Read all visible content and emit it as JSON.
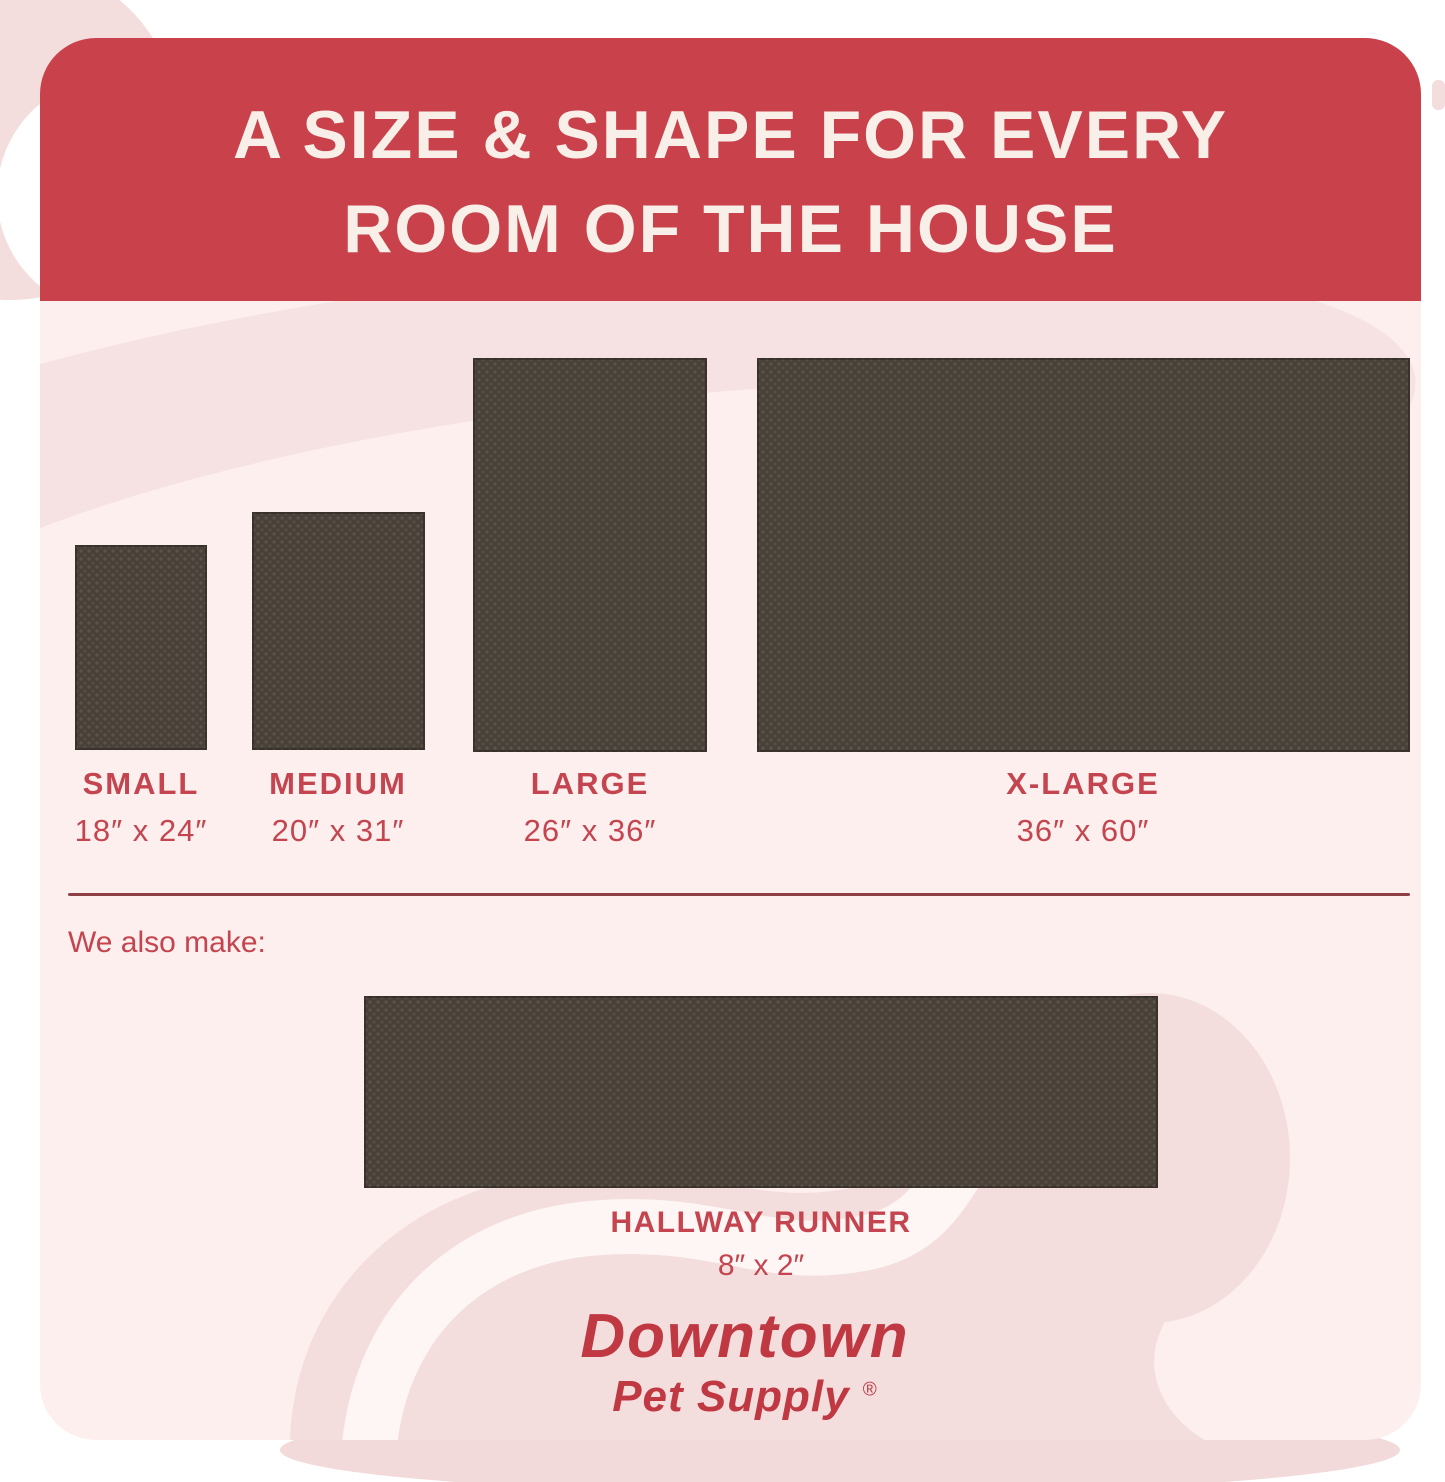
{
  "header": {
    "title_line1": "A SIZE & SHAPE FOR EVERY",
    "title_line2": "ROOM OF THE HOUSE"
  },
  "sizes": [
    {
      "name": "SMALL",
      "dims": "18″ x 24″"
    },
    {
      "name": "MEDIUM",
      "dims": "20″ x 31″"
    },
    {
      "name": "LARGE",
      "dims": "26″ x 36″"
    },
    {
      "name": "X-LARGE",
      "dims": "36″ x 60″"
    }
  ],
  "also_make": {
    "label": "We also make:"
  },
  "runner": {
    "name": "HALLWAY RUNNER",
    "dims": "8″ x 2″"
  },
  "brand": {
    "name": "Downtown",
    "tagline": "Pet Supply",
    "registered": "®"
  },
  "colors": {
    "banner_red": "#c8414b",
    "banner_text": "#f8efe8",
    "label_red": "#c4454f",
    "logo_red": "#bf3842",
    "rug_brown": "#48413a",
    "rug_dot": "#5e5347",
    "canvas_pink": "#fcefee",
    "decor_pink": "#f4dddd",
    "stripe_light": "#fdf6f4",
    "divider_red": "#8f4046",
    "page_background": "#ffffff"
  }
}
